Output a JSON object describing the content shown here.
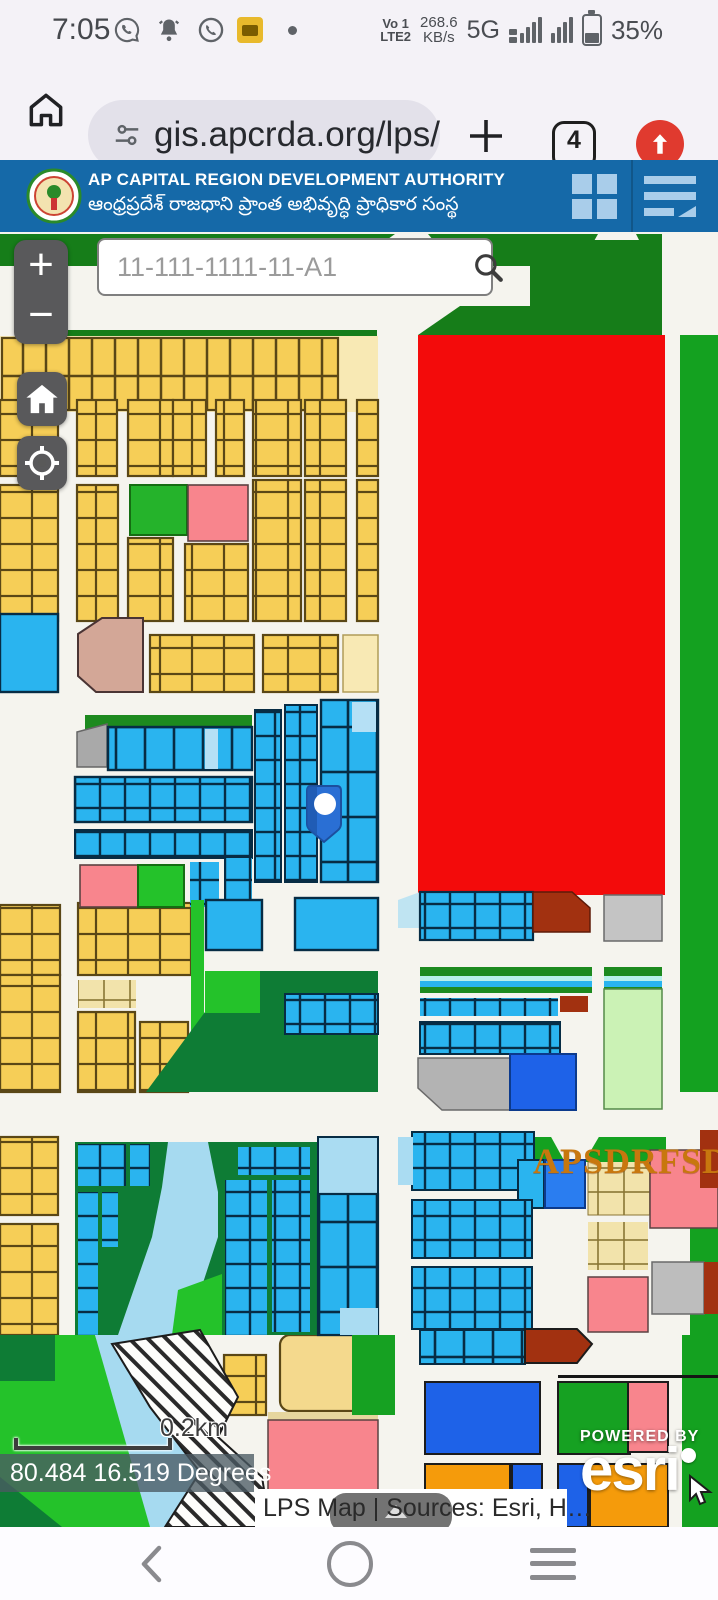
{
  "status_bar": {
    "time": "7:05",
    "volte_top": "Vo 1",
    "volte_bottom": "LTE2",
    "speed_top": "268.6",
    "speed_bottom": "KB/s",
    "network": "5G",
    "battery": "35%"
  },
  "browser": {
    "url": "gis.apcrda.org/lps/",
    "tab_count": "4"
  },
  "header": {
    "title": "AP CAPITAL REGION DEVELOPMENT AUTHORITY",
    "subtitle_telugu": "ఆంధ్రప్రదేశ్ రాజధాని ప్రాంత అభివృద్ధి ప్రాధికార సంస్థ"
  },
  "map_controls": {
    "zoom_in": "+",
    "zoom_out": "−",
    "search_placeholder": "11-111-1111-11-A1"
  },
  "map_overlay": {
    "watermark": "APSDRFSD",
    "scale_label": "0.2km",
    "coordinates": "80.484 16.519 Degrees",
    "attribution": "LPS Map | Sources: Esri, H…",
    "powered_by": "POWERED BY",
    "esri": "esri"
  },
  "colors": {
    "header_blue": "#1569a8",
    "parcel_yellow": "#f6ce57",
    "parcel_cyan": "#2ab4ef",
    "parcel_red": "#f30b0b",
    "parcel_green": "#14a120",
    "parcel_dark_green": "#0e7c35",
    "parcel_pink": "#f8858d",
    "parcel_blue": "#1e62e8",
    "parcel_orange": "#f59b0b",
    "parcel_maroon": "#a23110",
    "river_blue": "#a6daf0",
    "watermark_orange": "#c8770e"
  }
}
